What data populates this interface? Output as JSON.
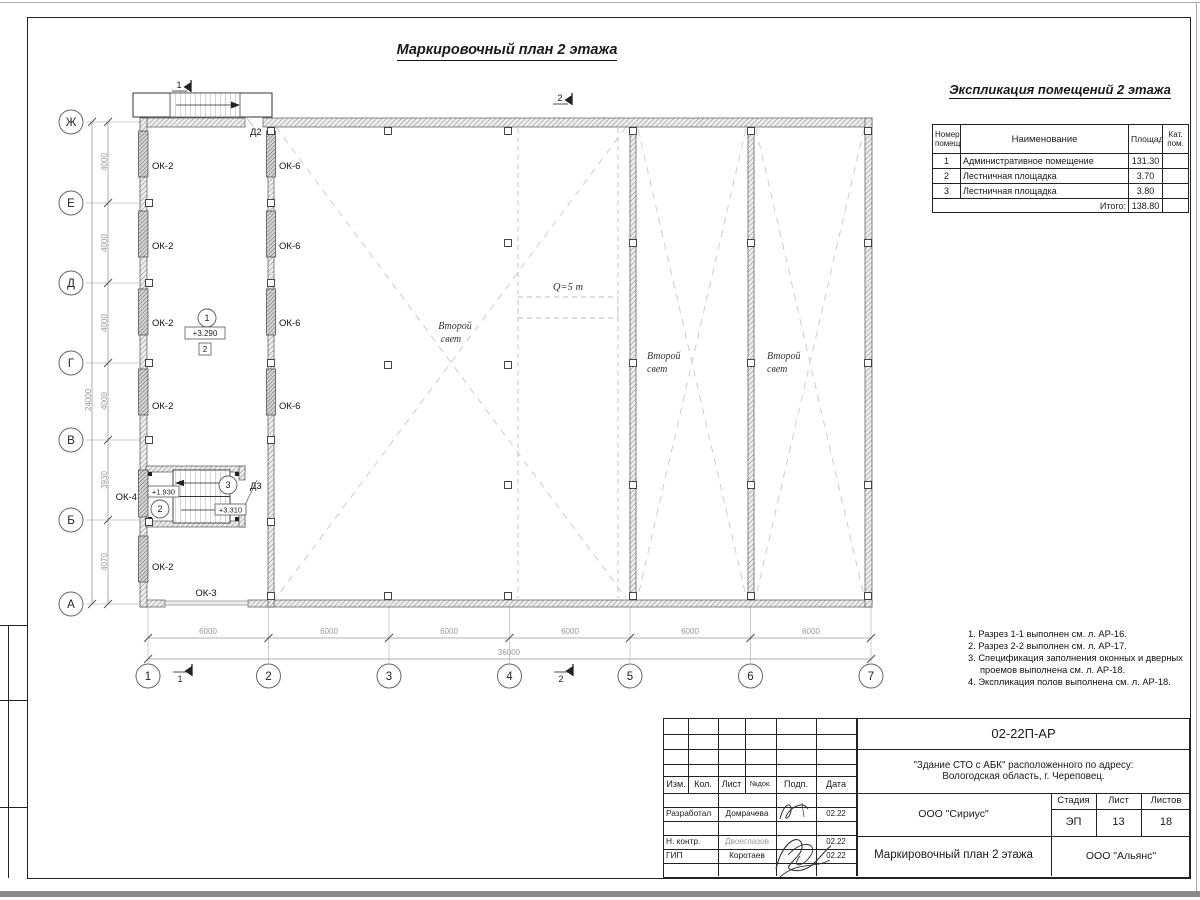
{
  "sheet": {
    "main_title": "Маркировочный план 2 этажа"
  },
  "plan": {
    "axes_rows": [
      "Ж",
      "Е",
      "Д",
      "Г",
      "В",
      "Б",
      "А"
    ],
    "axes_cols": [
      "1",
      "2",
      "3",
      "4",
      "5",
      "6",
      "7"
    ],
    "dim_4000": "4000",
    "dim_3930": "3930",
    "dim_4070": "4070",
    "dim_total_left": "24000",
    "dim_bay": "6000",
    "dim_total_bottom": "36000",
    "labels": {
      "ok2": "ОК-2",
      "ok3": "ОК-3",
      "ok4": "ОК-4",
      "ok6": "ОК-6",
      "d2": "Д2",
      "d3": "Д3",
      "second_light_1": "Второй",
      "second_light_2": "свет",
      "crane": "Q=5 т",
      "elev_room1": "+3.290",
      "floor_mark": "2",
      "elev_stair_low": "+1.930",
      "elev_stair_high": "+3.310",
      "room1": "1",
      "room2": "2",
      "room3": "3",
      "section1": "1",
      "section2": "2"
    }
  },
  "expl": {
    "title": "Экспликация помещений 2 этажа",
    "col_num": "Номер\nпомещ.",
    "col_name": "Наименование",
    "col_area": "Площадь",
    "col_cat": "Кат.\nпом.",
    "rows": [
      {
        "num": "1",
        "name": "Административное помещение",
        "area": "131.30",
        "cat": ""
      },
      {
        "num": "2",
        "name": "Лестничная площадка",
        "area": "3.70",
        "cat": ""
      },
      {
        "num": "3",
        "name": "Лестничная площадка",
        "area": "3.80",
        "cat": ""
      }
    ],
    "total_label": "Итого:",
    "total_area": "138.80"
  },
  "notes": [
    "1. Разрез 1-1 выполнен см. л. АР-16.",
    "2. Разрез 2-2 выполнен см. л. АР-17.",
    "3. Спецификация заполнения оконных и дверных",
    "проемов выполнена см. л. АР-18.",
    "4. Экспликация полов выполнена см. л. АР-18."
  ],
  "stamp": {
    "code": "02-22П-АР",
    "project": "\"Здание СТО с АБК\" расположенного по адресу:\nВологодская область, г. Череповец.",
    "org": "ООО \"Сириус\"",
    "org2": "ООО \"Альянс\"",
    "doc_title": "Маркировочный план 2 этажа",
    "head": {
      "izm": "Изм.",
      "kol": "Кол.",
      "list": "Лист",
      "ndok": "№док.",
      "podp": "Подп.",
      "data": "Дата"
    },
    "stage_label": "Стадия",
    "sheet_label": "Лист",
    "sheets_label": "Листов",
    "stage": "ЭП",
    "sheet_no": "13",
    "sheets_total": "18",
    "rows": [
      {
        "role": "Разработал",
        "name": "Домрачева",
        "date": "02.22"
      },
      {
        "role": "Н. контр.",
        "name": "Двоеглазов",
        "date": "02.22"
      },
      {
        "role": "ГИП",
        "name": "Коротаев",
        "date": "02.22"
      }
    ]
  }
}
